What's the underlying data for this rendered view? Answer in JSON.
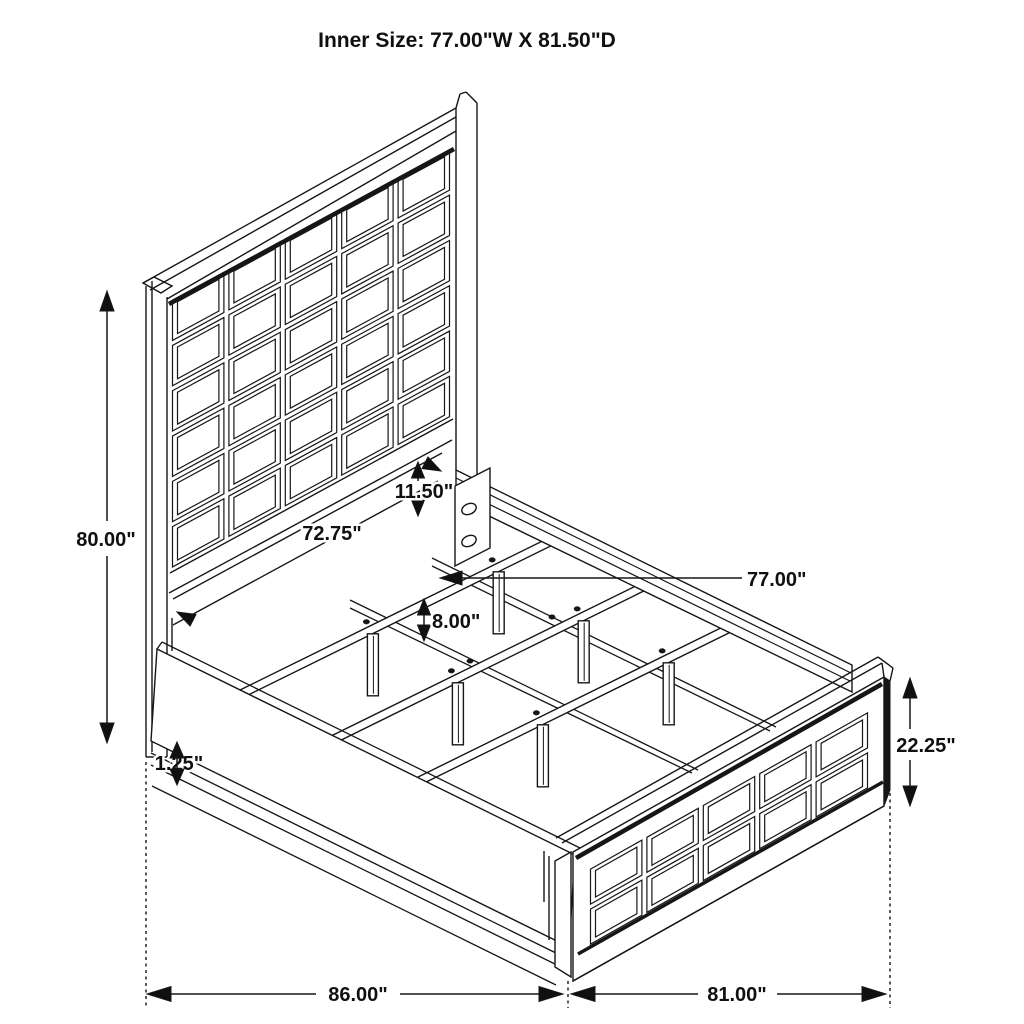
{
  "title": "Inner Size: 77.00\"W X 81.50\"D",
  "dimensions": {
    "headboard_height": "80.00\"",
    "headboard_inner_width": "72.75\"",
    "side_rail_height": "11.50\"",
    "inner_width": "77.00\"",
    "slat_support_height": "8.00\"",
    "base_trim_thickness": "1.25\"",
    "footboard_height": "22.25\"",
    "overall_length": "86.00\"",
    "overall_width": "81.00\""
  },
  "colors": {
    "line": "#161616",
    "background": "#ffffff"
  }
}
